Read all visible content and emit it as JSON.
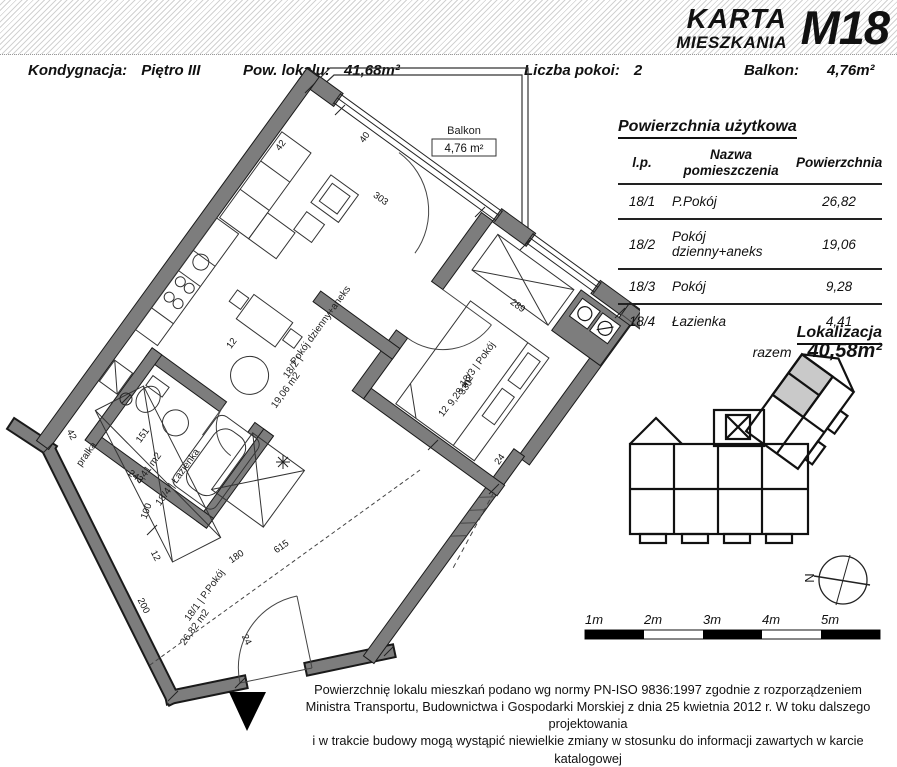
{
  "header": {
    "title_line1": "KARTA",
    "title_line2": "MIESZKANIA",
    "unit": "M18"
  },
  "info_bar": {
    "items": [
      {
        "label": "Kondygnacja:",
        "value": "Piętro III"
      },
      {
        "label": "Pow. lokalu:",
        "value": "41,68m²"
      },
      {
        "label": "Liczba pokoi:",
        "value": "2"
      },
      {
        "label": "Balkon:",
        "value": "4,76m²"
      }
    ]
  },
  "area_table": {
    "title": "Powierzchnia użytkowa",
    "columns": [
      "l.p.",
      "Nazwa pomieszczenia",
      "Powierzchnia"
    ],
    "rows": [
      {
        "id": "18/1",
        "name": "P.Pokój",
        "area": "26,82"
      },
      {
        "id": "18/2",
        "name": "Pokój dzienny+aneks",
        "area": "19,06"
      },
      {
        "id": "18/3",
        "name": "Pokój",
        "area": "9,28"
      },
      {
        "id": "18/4",
        "name": "Łazienka",
        "area": "4,41"
      }
    ],
    "total_label": "razem",
    "total_value": "40,58m²"
  },
  "localization": {
    "title": "Lokalizacja"
  },
  "floor_plan": {
    "balcony": {
      "label": "Balkon",
      "area": "4,76 m²"
    },
    "rooms": {
      "living": {
        "name_line": "Pokój dzienny+aneks",
        "id_line": "18/2 |",
        "area_line": "19,06 m2"
      },
      "bedroom": {
        "id_line": "18/3 | Pokój",
        "area_line": "9,28 m2"
      },
      "bath": {
        "id_line": "18/4 | Łazienka",
        "area_line": "4,41 m2"
      },
      "hall": {
        "id_line": "18/1 | P.Pokój",
        "area_line": "26,82 m2"
      }
    },
    "labels": {
      "washer": "pralka"
    },
    "dims": [
      "42",
      "40",
      "303",
      "289",
      "330",
      "12",
      "24",
      "151",
      "243",
      "100",
      "12",
      "200",
      "180",
      "615",
      "24",
      "42",
      "12"
    ]
  },
  "compass": {
    "north": "N"
  },
  "scale_bar": {
    "labels": [
      "1m",
      "2m",
      "3m",
      "4m",
      "5m"
    ]
  },
  "footer": {
    "lines": [
      "Powierzchnię lokalu mieszkań podano wg normy PN-ISO 9836:1997 zgodnie z rozporządzeniem",
      "Ministra Transportu, Budownictwa i Gospodarki Morskiej z dnia 25 kwietnia 2012 r. W toku dalszego projektowania",
      "i w trakcie budowy mogą wystąpić niewielkie zmiany w stosunku do informacji zawartych w karcie katalogowej"
    ]
  }
}
